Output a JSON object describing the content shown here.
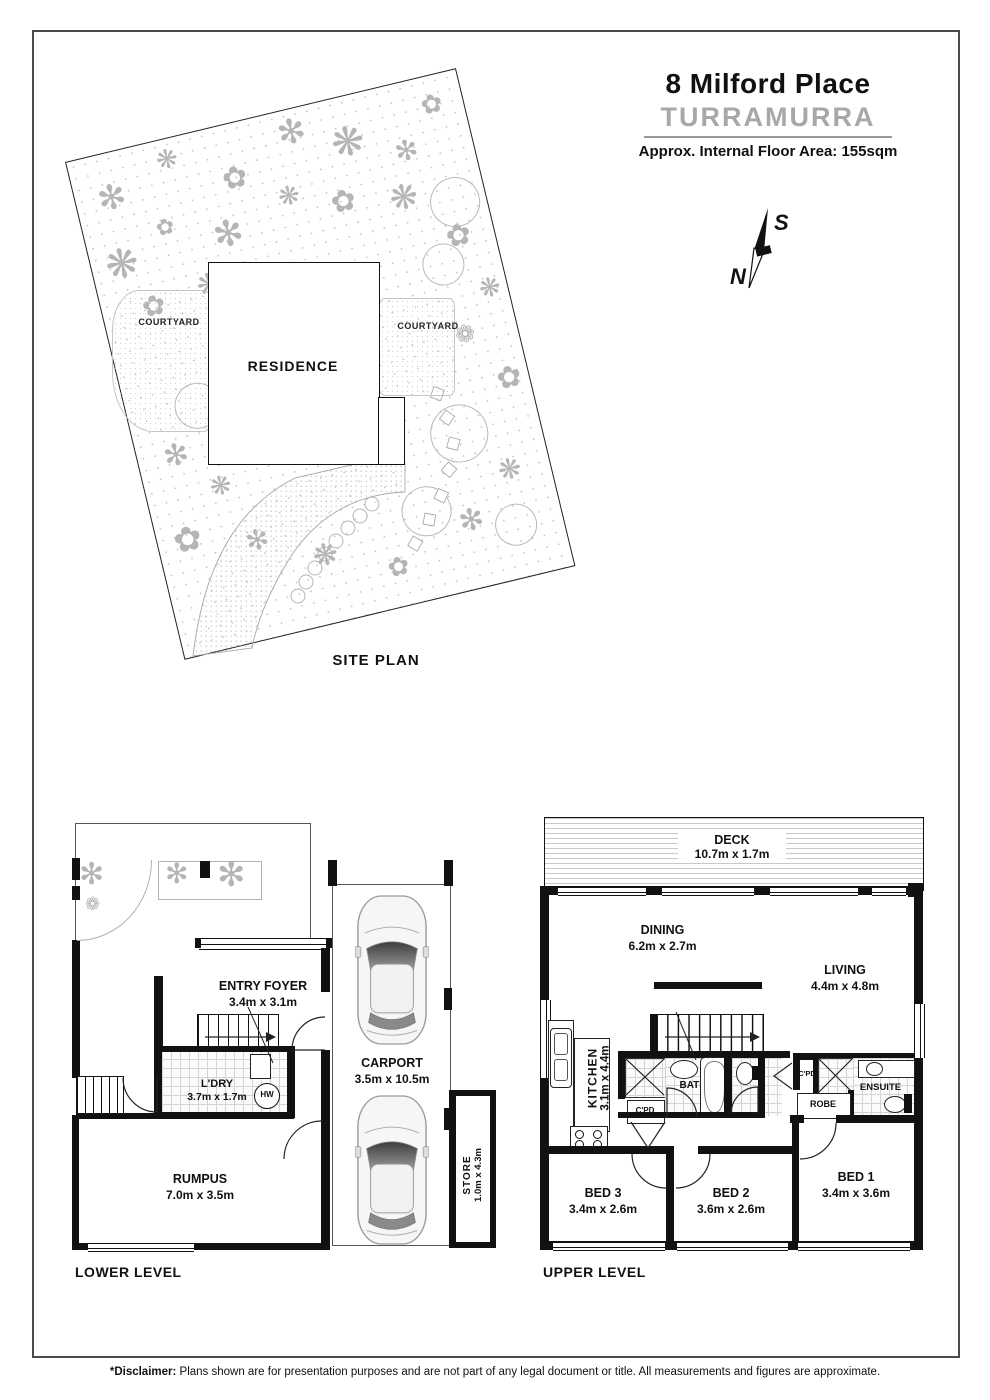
{
  "header": {
    "address": "8 Milford Place",
    "suburb": "TURRAMURRA",
    "floor_area": "Approx. Internal Floor Area: 155sqm"
  },
  "compass": {
    "south": "S",
    "north": "N"
  },
  "site_plan": {
    "label": "SITE PLAN",
    "residence": "RESIDENCE",
    "courtyard": "COURTYARD"
  },
  "lower_level": {
    "label": "LOWER LEVEL",
    "entry_foyer": {
      "name": "ENTRY FOYER",
      "dims": "3.4m x 3.1m"
    },
    "laundry": {
      "name": "L'DRY",
      "dims": "3.7m x 1.7m"
    },
    "hot_water": "HW",
    "rumpus": {
      "name": "RUMPUS",
      "dims": "7.0m x 3.5m"
    },
    "carport": {
      "name": "CARPORT",
      "dims": "3.5m x 10.5m"
    },
    "store": {
      "name": "STORE",
      "dims": "1.0m x 4.3m"
    }
  },
  "upper_level": {
    "label": "UPPER LEVEL",
    "deck": {
      "name": "DECK",
      "dims": "10.7m x 1.7m"
    },
    "dining": {
      "name": "DINING",
      "dims": "6.2m x 2.7m"
    },
    "living": {
      "name": "LIVING",
      "dims": "4.4m x 4.8m"
    },
    "kitchen": {
      "name": "KITCHEN",
      "dims": "3.1m x 4.4m"
    },
    "bath": {
      "name": "BATH"
    },
    "cupboard": {
      "name": "C'PD"
    },
    "ensuite": {
      "name": "ENSUITE"
    },
    "robe": {
      "name": "ROBE"
    },
    "bed1": {
      "name": "BED 1",
      "dims": "3.4m x 3.6m"
    },
    "bed2": {
      "name": "BED 2",
      "dims": "3.6m x 2.6m"
    },
    "bed3": {
      "name": "BED 3",
      "dims": "3.4m x 2.6m"
    }
  },
  "footer": {
    "disclaimer_label": "*Disclaimer:",
    "disclaimer_text": "Plans shown are for presentation purposes and are not part of any legal document or title. All measurements and figures are approximate."
  },
  "icons": {
    "plant": "✻",
    "flower": "✿",
    "bloom": "❋",
    "posy": "❁"
  },
  "colors": {
    "ink": "#111111",
    "suburb_gray": "#a8a8a8",
    "vegetation_gray": "#b5b5b5"
  }
}
